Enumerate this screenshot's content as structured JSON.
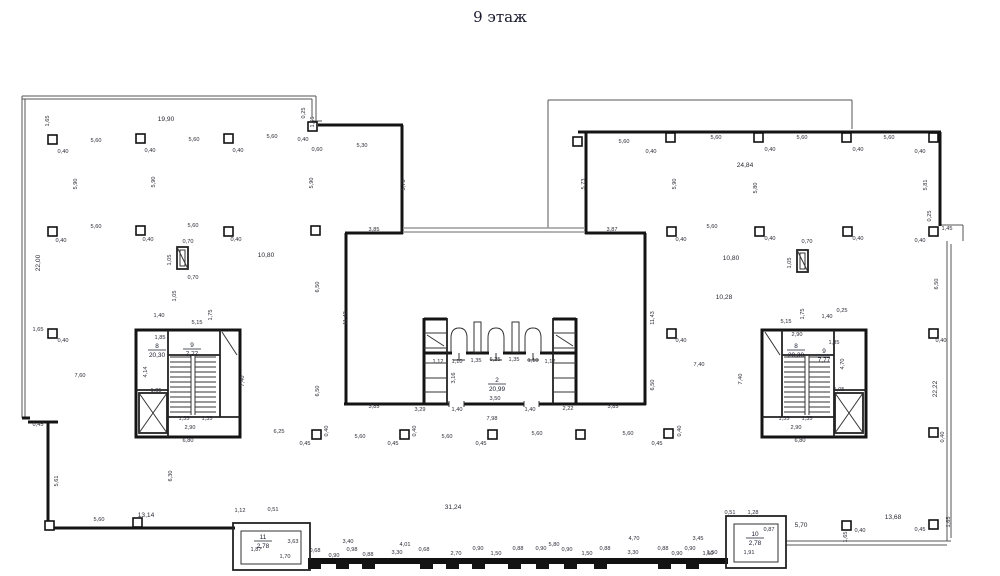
{
  "title": "9 этаж",
  "drawing": {
    "rooms": [
      {
        "n": "2",
        "a": "20,99",
        "x": 497,
        "y": 384
      },
      {
        "n": "8",
        "a": "20,30",
        "x": 157,
        "y": 350
      },
      {
        "n": "9",
        "a": "7,77",
        "x": 192,
        "y": 349
      },
      {
        "n": "8",
        "a": "20,30",
        "x": 796,
        "y": 350
      },
      {
        "n": "9",
        "a": "7,77",
        "x": 824,
        "y": 355
      },
      {
        "n": "11",
        "a": "2,78",
        "x": 263,
        "y": 541
      },
      {
        "n": "10",
        "a": "2,78",
        "x": 755,
        "y": 538
      }
    ],
    "labels": [
      {
        "t": "1,65",
        "x": 49,
        "y": 121,
        "r": 1
      },
      {
        "t": "19,90",
        "x": 166,
        "y": 121,
        "b": 1
      },
      {
        "t": "5,60",
        "x": 96,
        "y": 142
      },
      {
        "t": "5,60",
        "x": 194,
        "y": 141
      },
      {
        "t": "5,60",
        "x": 272,
        "y": 138
      },
      {
        "t": "0,40",
        "x": 63,
        "y": 153
      },
      {
        "t": "0,40",
        "x": 150,
        "y": 152
      },
      {
        "t": "0,40",
        "x": 238,
        "y": 152
      },
      {
        "t": "0,25",
        "x": 305,
        "y": 113,
        "r": 1
      },
      {
        "t": "1,46",
        "x": 314,
        "y": 122,
        "r": 1
      },
      {
        "t": "0,40",
        "x": 303,
        "y": 141
      },
      {
        "t": "0,60",
        "x": 317,
        "y": 151
      },
      {
        "t": "5,30",
        "x": 362,
        "y": 147
      },
      {
        "t": "5,90",
        "x": 77,
        "y": 184,
        "r": 1
      },
      {
        "t": "5,90",
        "x": 155,
        "y": 182,
        "r": 1
      },
      {
        "t": "5,90",
        "x": 313,
        "y": 183,
        "r": 1
      },
      {
        "t": "5,73",
        "x": 405,
        "y": 185,
        "r": 1
      },
      {
        "t": "22,00",
        "x": 40,
        "y": 263,
        "r": 1,
        "b": 1
      },
      {
        "t": "5,60",
        "x": 96,
        "y": 228
      },
      {
        "t": "5,60",
        "x": 193,
        "y": 227
      },
      {
        "t": "0,40",
        "x": 61,
        "y": 242
      },
      {
        "t": "0,40",
        "x": 148,
        "y": 241
      },
      {
        "t": "0,40",
        "x": 236,
        "y": 241
      },
      {
        "t": "0,70",
        "x": 188,
        "y": 243
      },
      {
        "t": "1,05",
        "x": 171,
        "y": 260,
        "r": 1
      },
      {
        "t": "0,70",
        "x": 193,
        "y": 279
      },
      {
        "t": "1,05",
        "x": 176,
        "y": 296,
        "r": 1
      },
      {
        "t": "10,80",
        "x": 266,
        "y": 257,
        "b": 1
      },
      {
        "t": "6,50",
        "x": 319,
        "y": 287,
        "r": 1
      },
      {
        "t": "11,43",
        "x": 347,
        "y": 318,
        "r": 1
      },
      {
        "t": "1,65",
        "x": 38,
        "y": 331
      },
      {
        "t": "0,40",
        "x": 63,
        "y": 342
      },
      {
        "t": "7,60",
        "x": 80,
        "y": 377
      },
      {
        "t": "6,50",
        "x": 319,
        "y": 391,
        "r": 1
      },
      {
        "t": "0,45",
        "x": 38,
        "y": 426
      },
      {
        "t": "5,61",
        "x": 58,
        "y": 481,
        "r": 1
      },
      {
        "t": "6,30",
        "x": 172,
        "y": 476,
        "r": 1
      },
      {
        "t": "5,60",
        "x": 99,
        "y": 521
      },
      {
        "t": "13,14",
        "x": 146,
        "y": 517,
        "b": 1
      },
      {
        "t": "1,40",
        "x": 159,
        "y": 317
      },
      {
        "t": "5,15",
        "x": 197,
        "y": 324
      },
      {
        "t": "1,75",
        "x": 212,
        "y": 315,
        "r": 1
      },
      {
        "t": "1,85",
        "x": 160,
        "y": 339
      },
      {
        "t": "4,14",
        "x": 147,
        "y": 372,
        "r": 1
      },
      {
        "t": "1,05",
        "x": 156,
        "y": 392
      },
      {
        "t": "7,40",
        "x": 244,
        "y": 381,
        "r": 1
      },
      {
        "t": "1,35",
        "x": 184,
        "y": 420
      },
      {
        "t": "1,35",
        "x": 207,
        "y": 420
      },
      {
        "t": "2,90",
        "x": 190,
        "y": 429
      },
      {
        "t": "6,80",
        "x": 188,
        "y": 442
      },
      {
        "t": "3,85",
        "x": 374,
        "y": 231
      },
      {
        "t": "3,87",
        "x": 612,
        "y": 231
      },
      {
        "t": "3,85",
        "x": 374,
        "y": 408
      },
      {
        "t": "3,29",
        "x": 420,
        "y": 411
      },
      {
        "t": "1,40",
        "x": 457,
        "y": 411
      },
      {
        "t": "3,50",
        "x": 495,
        "y": 400
      },
      {
        "t": "1,40",
        "x": 530,
        "y": 411
      },
      {
        "t": "2,22",
        "x": 568,
        "y": 410
      },
      {
        "t": "3,85",
        "x": 613,
        "y": 408
      },
      {
        "t": "7,98",
        "x": 492,
        "y": 420
      },
      {
        "t": "1,12",
        "x": 438,
        "y": 363
      },
      {
        "t": "1,10",
        "x": 457,
        "y": 363
      },
      {
        "t": "1,35",
        "x": 476,
        "y": 362
      },
      {
        "t": "6,25",
        "x": 495,
        "y": 361
      },
      {
        "t": "1,35",
        "x": 514,
        "y": 361
      },
      {
        "t": "1,10",
        "x": 533,
        "y": 362
      },
      {
        "t": "1,12",
        "x": 550,
        "y": 363
      },
      {
        "t": "3,16",
        "x": 455,
        "y": 378,
        "r": 1
      },
      {
        "t": "11,43",
        "x": 654,
        "y": 318,
        "r": 1
      },
      {
        "t": "10,28",
        "x": 724,
        "y": 299,
        "b": 1
      },
      {
        "t": "10,80",
        "x": 731,
        "y": 260,
        "b": 1
      },
      {
        "t": "7,40",
        "x": 699,
        "y": 366
      },
      {
        "t": "6,50",
        "x": 654,
        "y": 385,
        "r": 1
      },
      {
        "t": "0,40",
        "x": 681,
        "y": 342
      },
      {
        "t": "24,84",
        "x": 745,
        "y": 167,
        "b": 1
      },
      {
        "t": "5,60",
        "x": 624,
        "y": 143
      },
      {
        "t": "5,60",
        "x": 716,
        "y": 139
      },
      {
        "t": "5,60",
        "x": 802,
        "y": 139
      },
      {
        "t": "5,60",
        "x": 889,
        "y": 139
      },
      {
        "t": "0,40",
        "x": 651,
        "y": 153
      },
      {
        "t": "0,40",
        "x": 770,
        "y": 151
      },
      {
        "t": "0,40",
        "x": 858,
        "y": 151
      },
      {
        "t": "0,40",
        "x": 920,
        "y": 153
      },
      {
        "t": "5,90",
        "x": 676,
        "y": 184,
        "r": 1
      },
      {
        "t": "5,80",
        "x": 757,
        "y": 188,
        "r": 1
      },
      {
        "t": "5,81",
        "x": 927,
        "y": 185,
        "r": 1
      },
      {
        "t": "5,73",
        "x": 585,
        "y": 184,
        "r": 1
      },
      {
        "t": "0,70",
        "x": 807,
        "y": 243
      },
      {
        "t": "1,05",
        "x": 791,
        "y": 263,
        "r": 1
      },
      {
        "t": "5,60",
        "x": 712,
        "y": 228
      },
      {
        "t": "0,40",
        "x": 681,
        "y": 241
      },
      {
        "t": "0,40",
        "x": 770,
        "y": 240
      },
      {
        "t": "0,40",
        "x": 858,
        "y": 240
      },
      {
        "t": "0,40",
        "x": 920,
        "y": 242
      },
      {
        "t": "6,50",
        "x": 938,
        "y": 284,
        "r": 1
      },
      {
        "t": "1,45",
        "x": 947,
        "y": 230
      },
      {
        "t": "0,25",
        "x": 931,
        "y": 216,
        "r": 1
      },
      {
        "t": "22,22",
        "x": 937,
        "y": 389,
        "r": 1,
        "b": 1
      },
      {
        "t": "0,40",
        "x": 941,
        "y": 342
      },
      {
        "t": "5,15",
        "x": 786,
        "y": 323
      },
      {
        "t": "1,75",
        "x": 804,
        "y": 314,
        "r": 1
      },
      {
        "t": "1,40",
        "x": 827,
        "y": 318
      },
      {
        "t": "0,25",
        "x": 842,
        "y": 312
      },
      {
        "t": "2,90",
        "x": 797,
        "y": 336
      },
      {
        "t": "1,85",
        "x": 834,
        "y": 344
      },
      {
        "t": "4,70",
        "x": 844,
        "y": 364,
        "r": 1
      },
      {
        "t": "7,40",
        "x": 742,
        "y": 379,
        "r": 1
      },
      {
        "t": "1,05",
        "x": 839,
        "y": 391
      },
      {
        "t": "1,35",
        "x": 784,
        "y": 420
      },
      {
        "t": "1,35",
        "x": 807,
        "y": 420
      },
      {
        "t": "2,90",
        "x": 796,
        "y": 429
      },
      {
        "t": "6,80",
        "x": 800,
        "y": 442
      },
      {
        "t": "6,25",
        "x": 279,
        "y": 433
      },
      {
        "t": "0,45",
        "x": 305,
        "y": 445
      },
      {
        "t": "0,40",
        "x": 328,
        "y": 431,
        "r": 1
      },
      {
        "t": "5,60",
        "x": 360,
        "y": 438
      },
      {
        "t": "0,45",
        "x": 393,
        "y": 445
      },
      {
        "t": "0,40",
        "x": 416,
        "y": 431,
        "r": 1
      },
      {
        "t": "5,60",
        "x": 447,
        "y": 438
      },
      {
        "t": "0,45",
        "x": 481,
        "y": 445
      },
      {
        "t": "5,60",
        "x": 537,
        "y": 435
      },
      {
        "t": "5,60",
        "x": 628,
        "y": 435
      },
      {
        "t": "0,45",
        "x": 657,
        "y": 445
      },
      {
        "t": "0,40",
        "x": 681,
        "y": 431,
        "r": 1
      },
      {
        "t": "31,24",
        "x": 453,
        "y": 509,
        "b": 1
      },
      {
        "t": "1,12",
        "x": 240,
        "y": 512
      },
      {
        "t": "0,51",
        "x": 273,
        "y": 511
      },
      {
        "t": "1,87",
        "x": 256,
        "y": 551
      },
      {
        "t": "1,70",
        "x": 285,
        "y": 558
      },
      {
        "t": "3,63",
        "x": 293,
        "y": 543
      },
      {
        "t": "0,68",
        "x": 315,
        "y": 552
      },
      {
        "t": "0,90",
        "x": 334,
        "y": 557
      },
      {
        "t": "3,40",
        "x": 348,
        "y": 543
      },
      {
        "t": "0,98",
        "x": 352,
        "y": 551
      },
      {
        "t": "0,88",
        "x": 368,
        "y": 556
      },
      {
        "t": "4,01",
        "x": 405,
        "y": 546
      },
      {
        "t": "3,30",
        "x": 397,
        "y": 554
      },
      {
        "t": "0,68",
        "x": 424,
        "y": 551
      },
      {
        "t": "2,70",
        "x": 456,
        "y": 555
      },
      {
        "t": "0,90",
        "x": 478,
        "y": 550
      },
      {
        "t": "1,50",
        "x": 496,
        "y": 555
      },
      {
        "t": "0,88",
        "x": 518,
        "y": 550
      },
      {
        "t": "0,90",
        "x": 541,
        "y": 550
      },
      {
        "t": "5,80",
        "x": 554,
        "y": 546
      },
      {
        "t": "0,90",
        "x": 567,
        "y": 551
      },
      {
        "t": "1,50",
        "x": 587,
        "y": 555
      },
      {
        "t": "0,88",
        "x": 605,
        "y": 550
      },
      {
        "t": "4,70",
        "x": 634,
        "y": 540
      },
      {
        "t": "3,30",
        "x": 633,
        "y": 554
      },
      {
        "t": "0,88",
        "x": 663,
        "y": 550
      },
      {
        "t": "0,90",
        "x": 677,
        "y": 555
      },
      {
        "t": "0,90",
        "x": 690,
        "y": 550
      },
      {
        "t": "1,50",
        "x": 708,
        "y": 555
      },
      {
        "t": "3,45",
        "x": 698,
        "y": 540
      },
      {
        "t": "0,51",
        "x": 730,
        "y": 514
      },
      {
        "t": "1,28",
        "x": 753,
        "y": 514
      },
      {
        "t": "0,87",
        "x": 769,
        "y": 531
      },
      {
        "t": "1,91",
        "x": 749,
        "y": 554
      },
      {
        "t": "1,50",
        "x": 712,
        "y": 554
      },
      {
        "t": "5,70",
        "x": 801,
        "y": 527,
        "b": 1
      },
      {
        "t": "13,68",
        "x": 893,
        "y": 519,
        "b": 1
      },
      {
        "t": "1,65",
        "x": 847,
        "y": 537,
        "r": 1
      },
      {
        "t": "0,40",
        "x": 860,
        "y": 532
      },
      {
        "t": "0,45",
        "x": 920,
        "y": 531
      },
      {
        "t": "1,65",
        "x": 950,
        "y": 522,
        "r": 1
      },
      {
        "t": "0,40",
        "x": 944,
        "y": 437,
        "r": 1
      }
    ]
  }
}
